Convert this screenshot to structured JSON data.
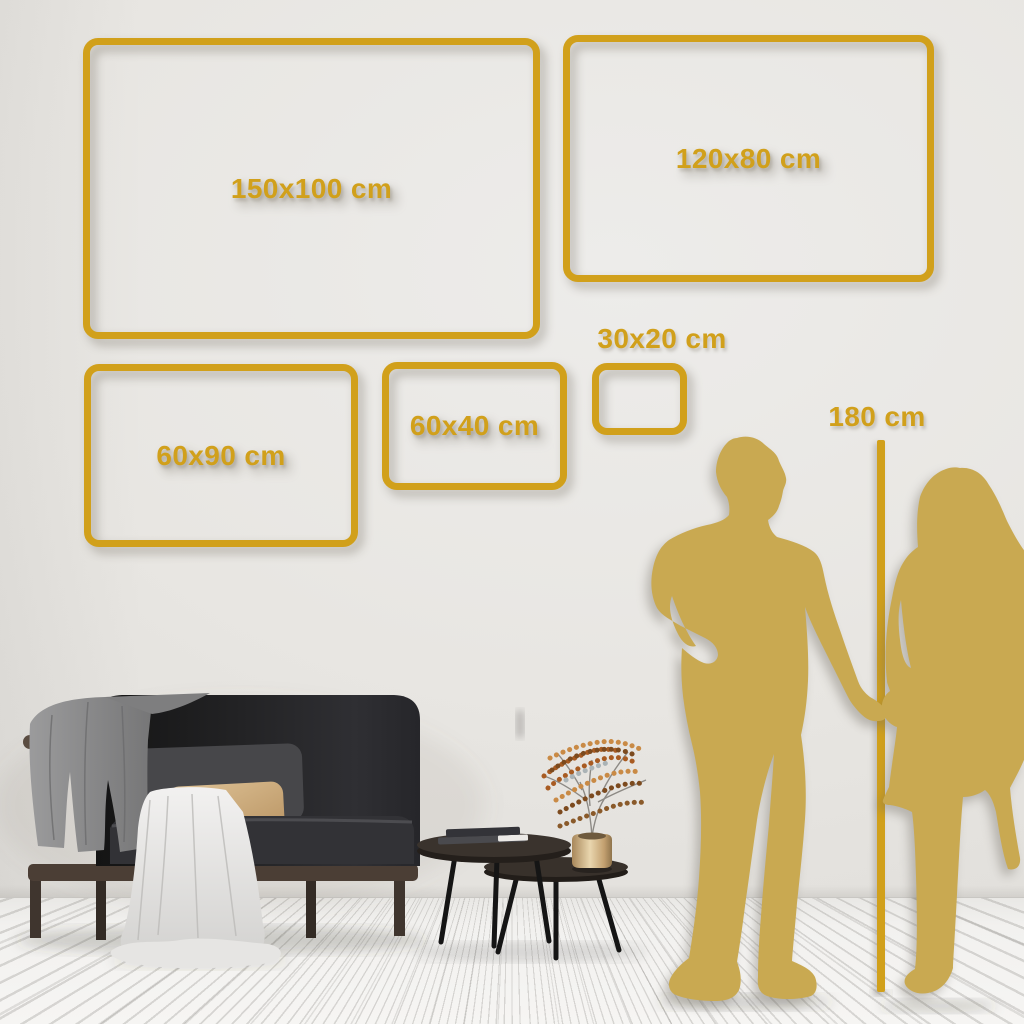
{
  "size_guide": {
    "frames": [
      {
        "size": "150x100",
        "label": "150x100 cm"
      },
      {
        "size": "120x80",
        "label": "120x80 cm"
      },
      {
        "size": "60x90",
        "label": "60x90 cm"
      },
      {
        "size": "60x40",
        "label": "60x40 cm"
      },
      {
        "size": "30x20",
        "label": "30x20 cm"
      }
    ],
    "height_reference": {
      "label": "180 cm"
    }
  },
  "scene": {
    "objects": [
      "sofa",
      "gray-throw-blanket",
      "white-throw-blanket",
      "back-cushion",
      "tan-pillow",
      "nesting-coffee-tables",
      "books",
      "brass-vase",
      "dried-flower-branches",
      "man-silhouette",
      "woman-silhouette",
      "height-reference-line"
    ]
  },
  "colors": {
    "frame_gold": "#D1A01B",
    "silhouette_gold": "#C9A951",
    "wall": "#E8E6E2",
    "floor": "#F2F1EF",
    "sofa_dark": "#232325",
    "table_brown": "#362F29",
    "brass": "#D9C193",
    "berry_rust": "#A85B22"
  }
}
